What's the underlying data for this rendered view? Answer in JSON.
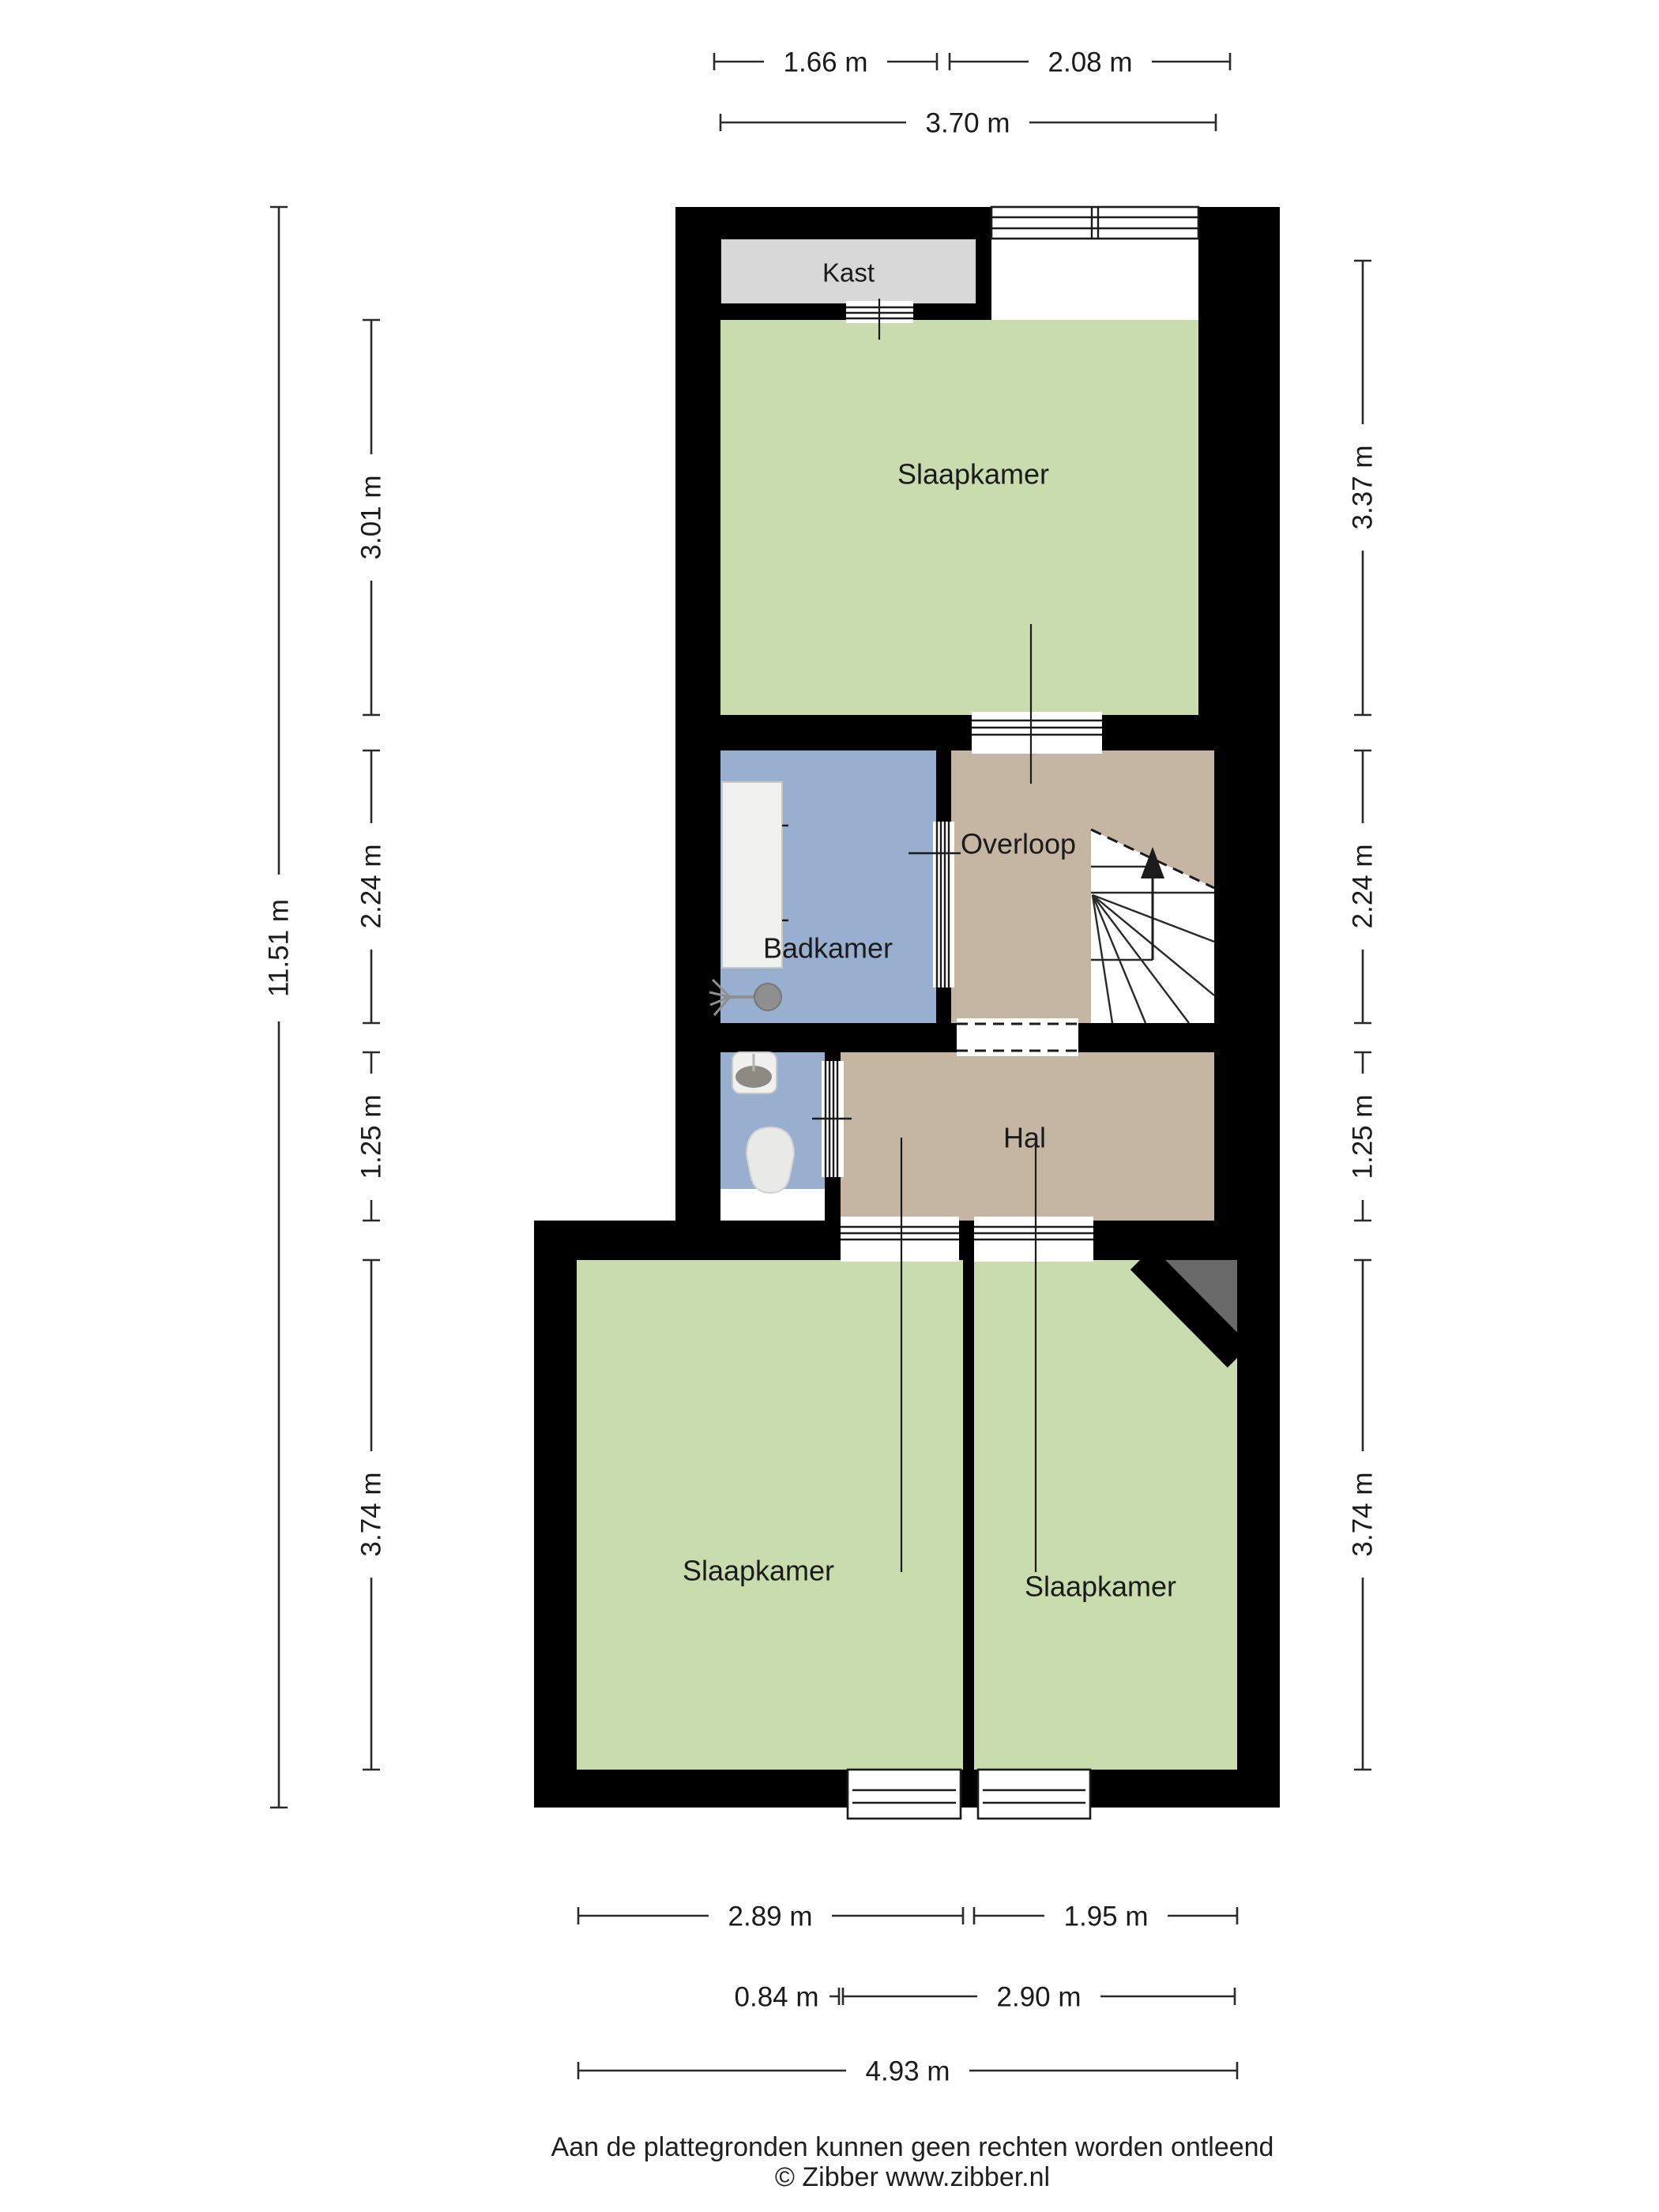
{
  "floorplan": {
    "rooms": {
      "kast": {
        "label": "Kast"
      },
      "slaapkamer_boven": {
        "label": "Slaapkamer"
      },
      "badkamer": {
        "label": "Badkamer"
      },
      "overloop": {
        "label": "Overloop"
      },
      "hal": {
        "label": "Hal"
      },
      "slaapkamer_links": {
        "label": "Slaapkamer"
      },
      "slaapkamer_rechts": {
        "label": "Slaapkamer"
      }
    },
    "dimensions": {
      "top": {
        "segment1": "1.66 m",
        "segment2": "2.08 m",
        "total": "3.70 m"
      },
      "left": {
        "total": "11.51 m",
        "segment1": "3.01 m",
        "segment2": "2.24 m",
        "segment3": "1.25 m",
        "segment4": "3.74 m"
      },
      "right": {
        "segment1": "3.37 m",
        "segment2": "2.24 m",
        "segment3": "1.25 m",
        "segment4": "3.74 m"
      },
      "bottom": {
        "row1_segment1": "2.89 m",
        "row1_segment2": "1.95 m",
        "row2_segment1": "0.84 m",
        "row2_segment2": "2.90 m",
        "total": "4.93 m"
      }
    },
    "colors": {
      "bedroom_green": "#c9dcae",
      "bathroom_blue": "#99afd0",
      "hall_tan": "#c5b5a3",
      "closet_gray": "#d8d8d8",
      "corner_gray": "#696969",
      "wall_black": "#000000"
    }
  },
  "footer": {
    "disclaimer": "Aan de plattegronden kunnen geen rechten worden ontleend",
    "copyright": "© Zibber www.zibber.nl"
  }
}
